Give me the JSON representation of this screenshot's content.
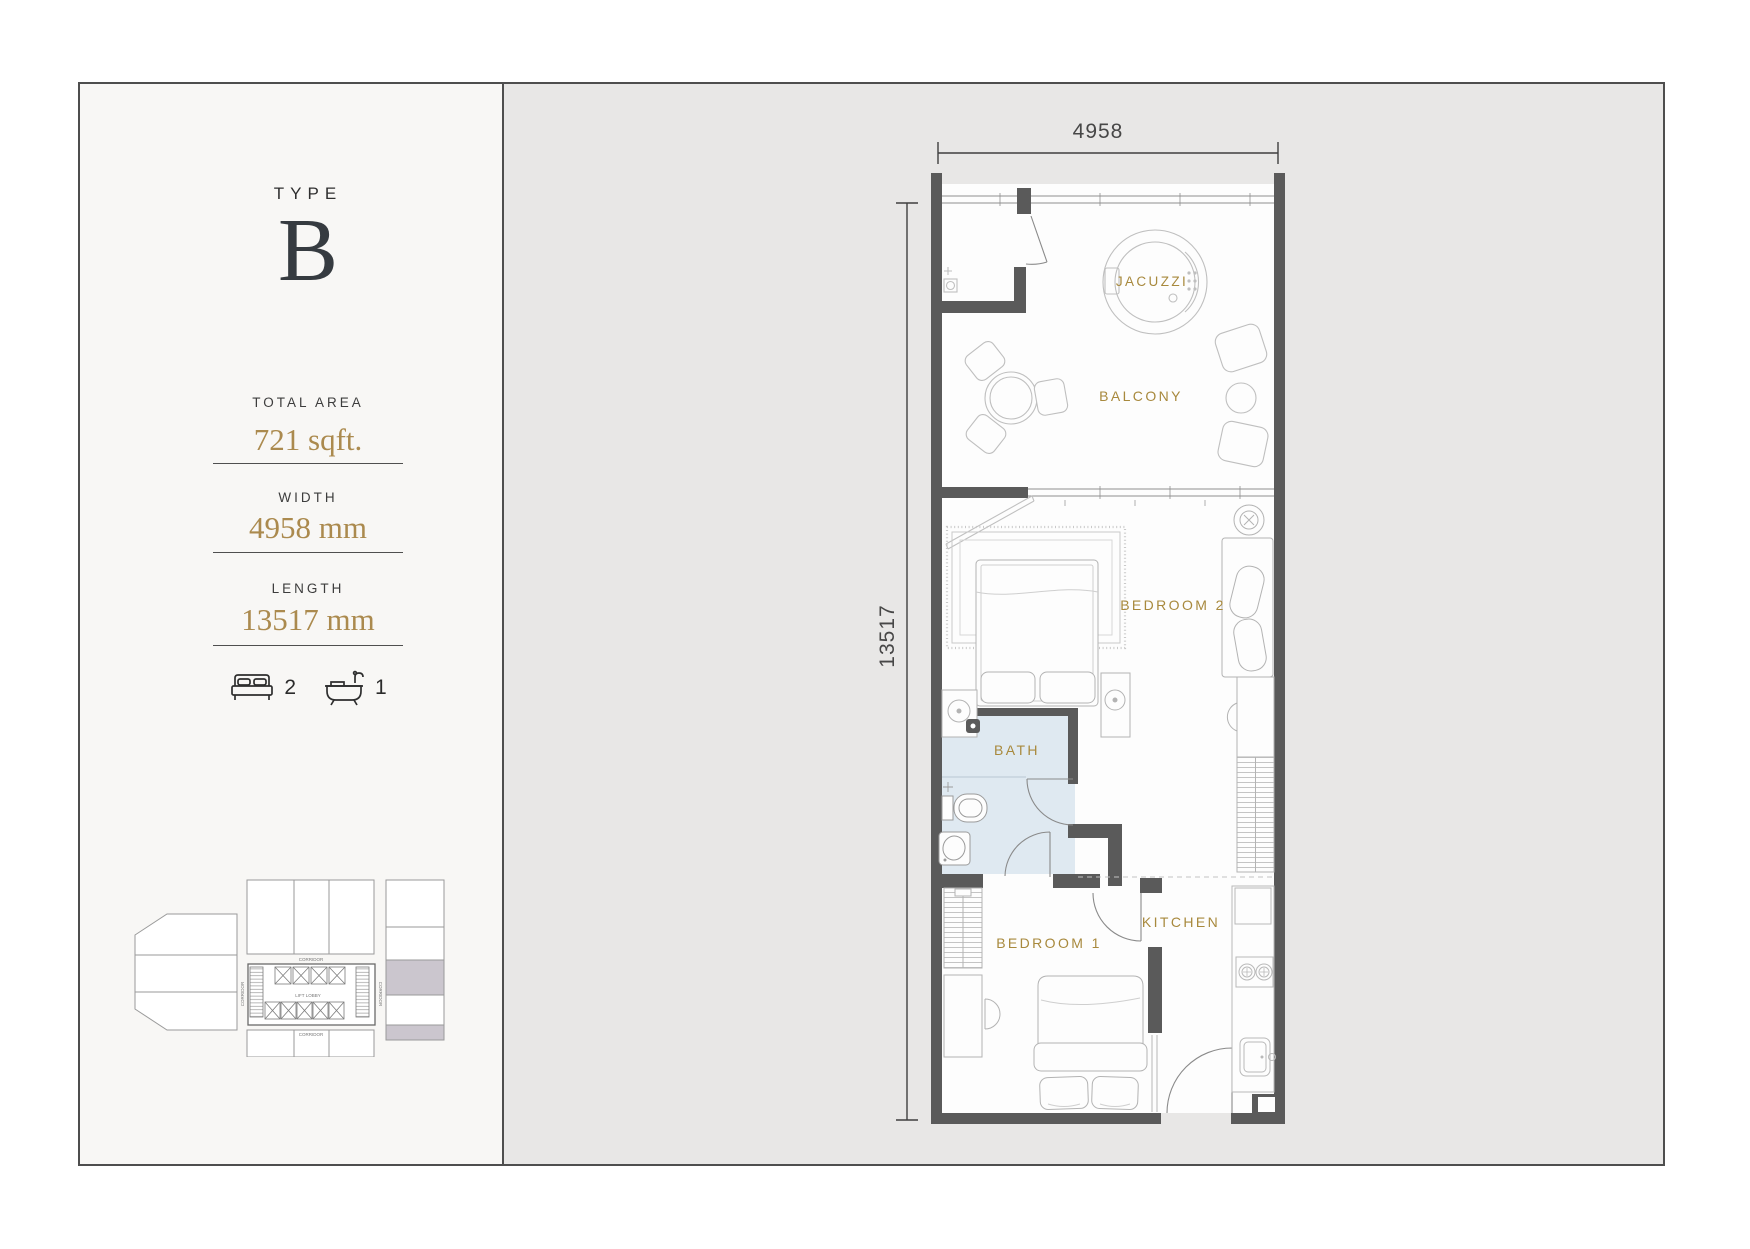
{
  "panel": {
    "type_label": "TYPE",
    "type_value": "B",
    "total_area_label": "TOTAL AREA",
    "total_area_value": "721 sqft.",
    "width_label": "WIDTH",
    "width_value": "4958 mm",
    "length_label": "LENGTH",
    "length_value": "13517 mm",
    "bedrooms_count": "2",
    "baths_count": "1"
  },
  "plan": {
    "dim_width": "4958",
    "dim_length": "13517",
    "rooms": {
      "jacuzzi": "JACUZZI",
      "balcony": "BALCONY",
      "bedroom2": "BEDROOM 2",
      "bath": "BATH",
      "bedroom1": "BEDROOM 1",
      "kitchen": "KITCHEN"
    }
  },
  "keyplan": {
    "corridor_top": "CORRIDOR",
    "corridor_bottom": "CORRIDOR",
    "corridor_left": "CORRIDOR",
    "corridor_right": "CORRIDOR",
    "lift_lobby": "LIFT LOBBY"
  },
  "colors": {
    "accent_gold": "#ab8a4e",
    "room_label_gold": "#a8893d",
    "wall": "#5a5a5a",
    "bath_floor": "#dfe9f1",
    "keyplan_highlight": "#cbc6ce",
    "panel_bg": "#f8f7f5",
    "canvas_bg": "#e8e7e6"
  }
}
